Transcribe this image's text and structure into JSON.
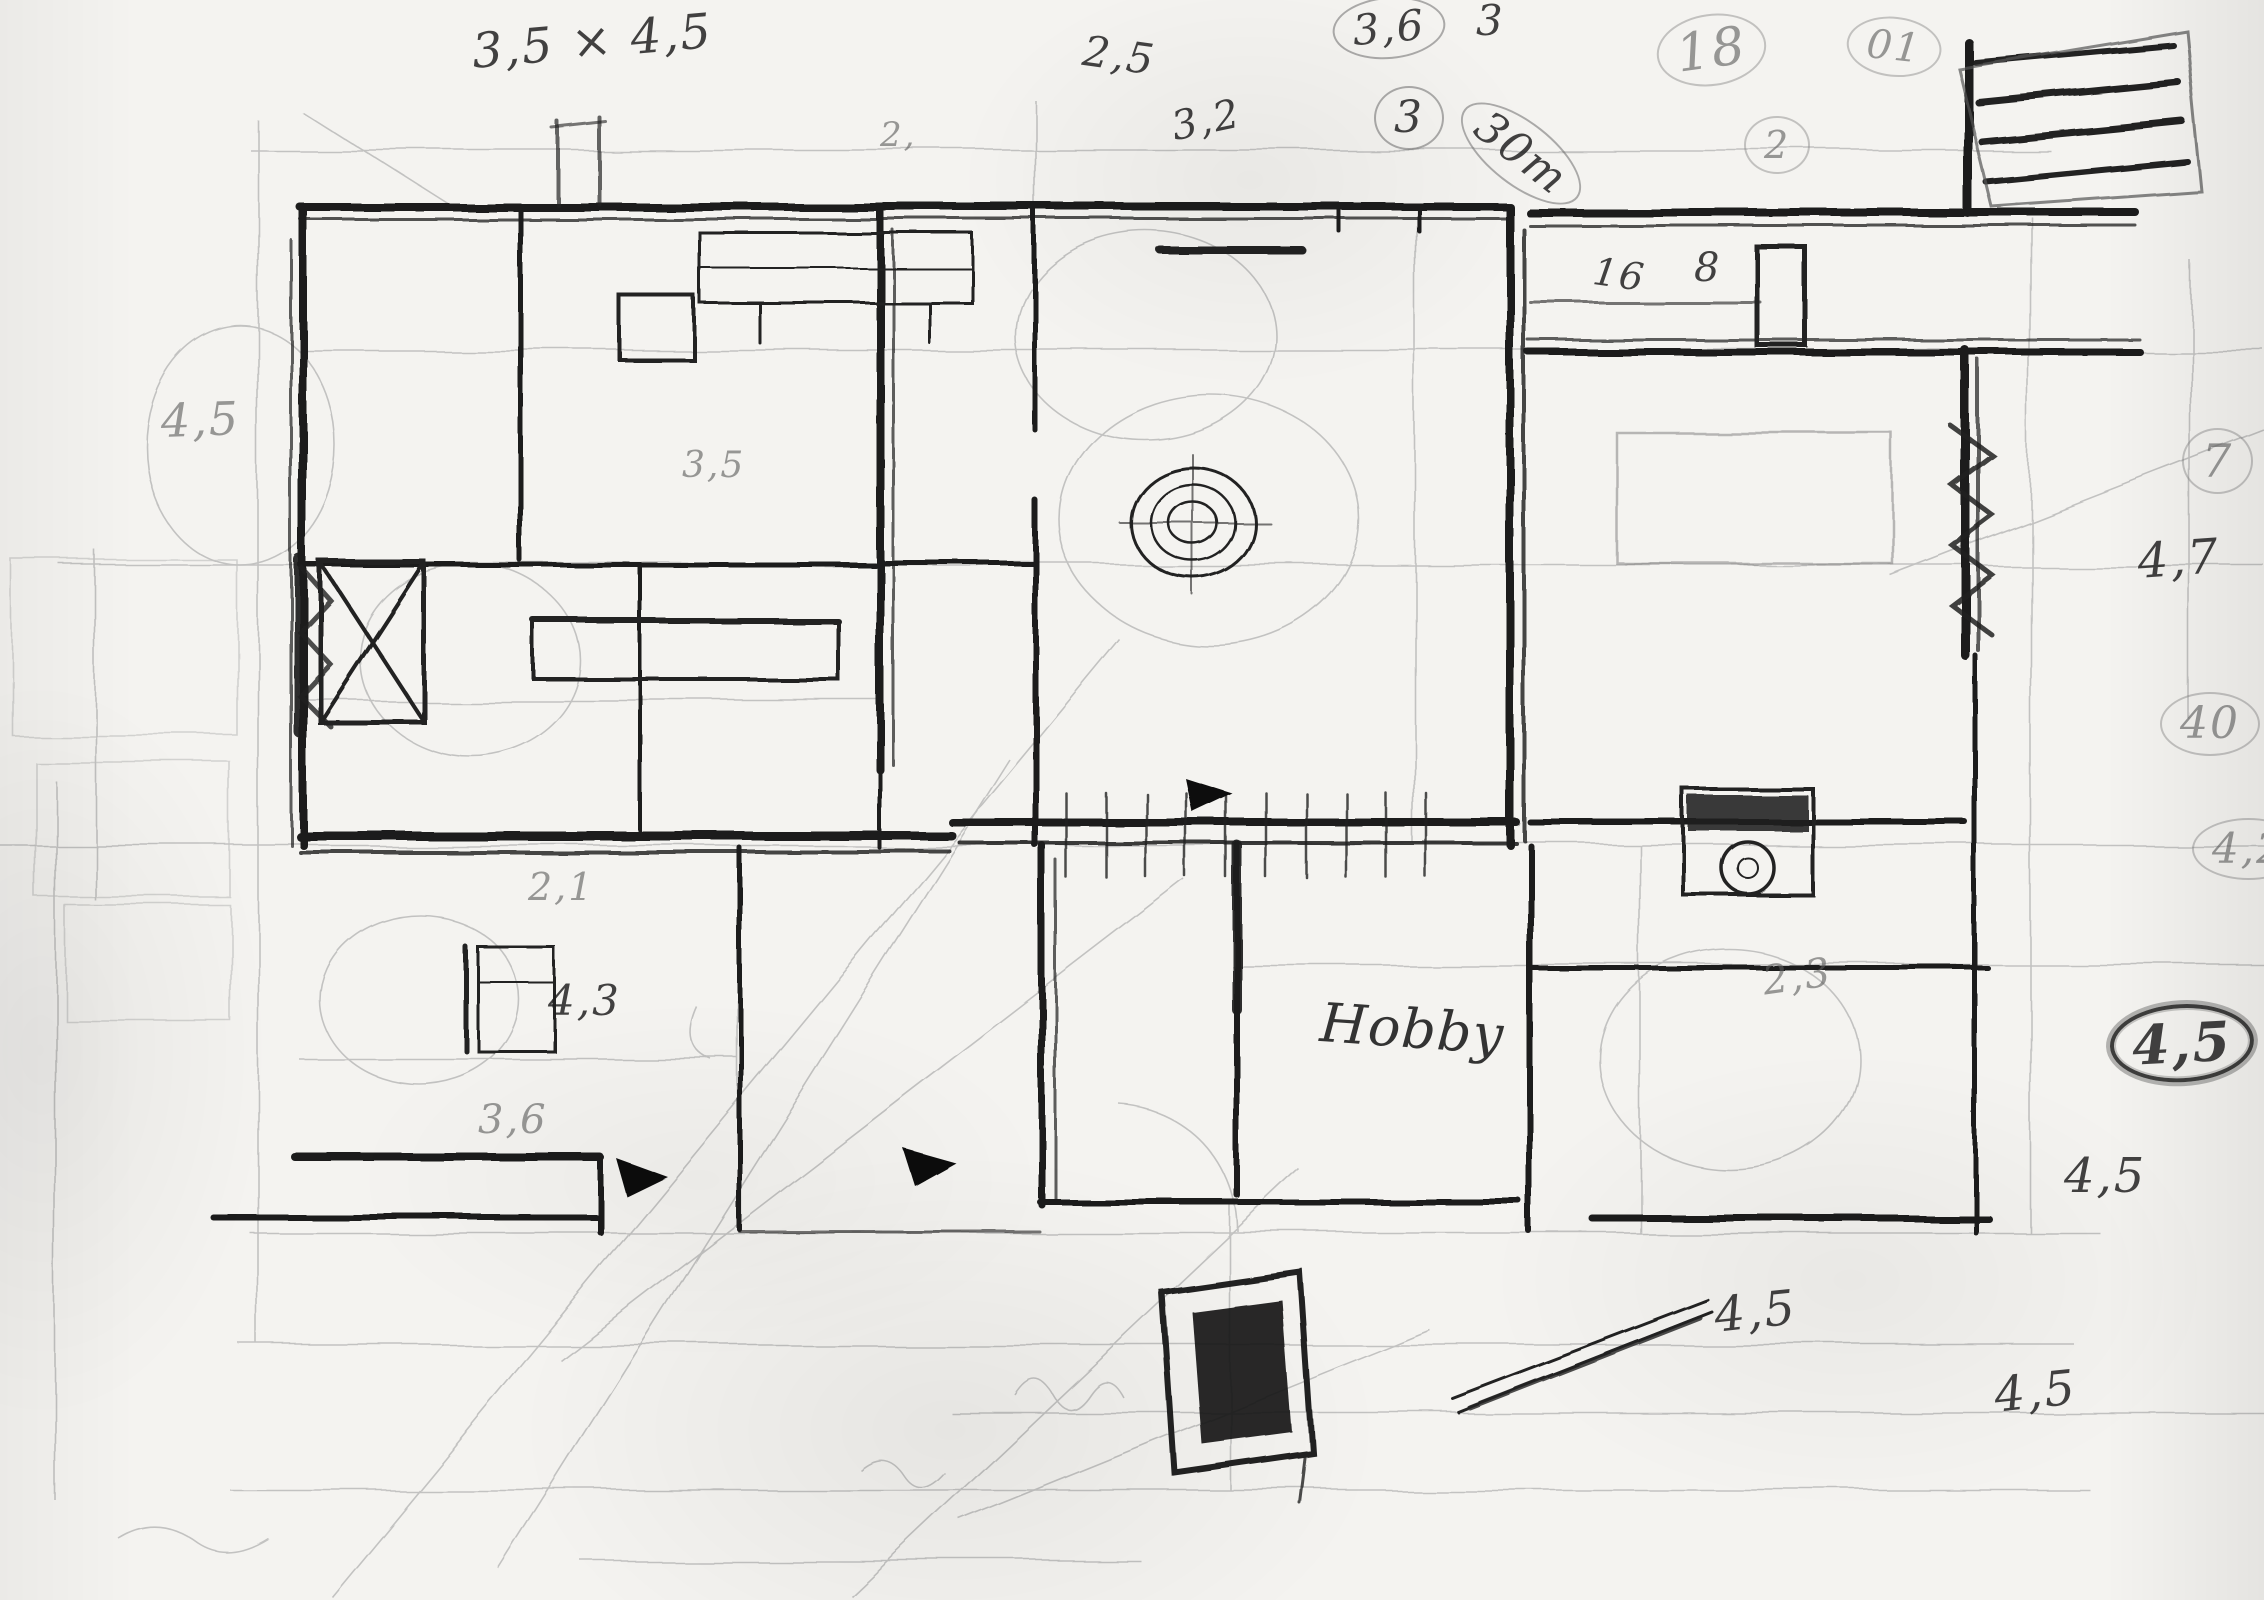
{
  "sketch": {
    "kind": "hand-drawn-floor-plan",
    "room_label": "Hobby"
  },
  "palette": {
    "paper": "#f4f3f0",
    "ink": "#1b1b1b",
    "pencil": "#8d8d8d"
  },
  "annotations": [
    {
      "id": "dim-top-left",
      "text": "3,5 × 4,5",
      "x": 470,
      "y": 28,
      "size": 48,
      "rotate": -5,
      "style": "ink"
    },
    {
      "id": "dim-2-5",
      "text": "2,5",
      "x": 1086,
      "y": 30,
      "size": 42,
      "rotate": 8,
      "style": "ink"
    },
    {
      "id": "dim-2-dot",
      "text": "2,",
      "x": 880,
      "y": 118,
      "size": 34,
      "rotate": 0,
      "style": "pencil"
    },
    {
      "id": "dim-3-2",
      "text": "3,2",
      "x": 1168,
      "y": 108,
      "size": 40,
      "rotate": -12,
      "style": "ink"
    },
    {
      "id": "dim-3-6-top",
      "text": "3,6",
      "x": 1330,
      "y": 2,
      "size": 42,
      "rotate": -5,
      "style": "ink",
      "circled": true
    },
    {
      "id": "dim-3-circled",
      "text": "3",
      "x": 1374,
      "y": 86,
      "size": 44,
      "rotate": 0,
      "style": "ink",
      "circled": true
    },
    {
      "id": "dim-3-top",
      "text": "3",
      "x": 1476,
      "y": 0,
      "size": 42,
      "rotate": 0,
      "style": "ink"
    },
    {
      "id": "dim-30m",
      "text": "30m",
      "x": 1484,
      "y": 84,
      "size": 44,
      "rotate": 38,
      "style": "ink",
      "circled": true
    },
    {
      "id": "dim-18",
      "text": "18",
      "x": 1652,
      "y": 22,
      "size": 52,
      "rotate": -8,
      "style": "pencil",
      "circled": true
    },
    {
      "id": "dim-01",
      "text": "01",
      "x": 1850,
      "y": 12,
      "size": 40,
      "rotate": 6,
      "style": "pencil",
      "circled": true
    },
    {
      "id": "dim-2-circled",
      "text": "2",
      "x": 1744,
      "y": 116,
      "size": 38,
      "rotate": 0,
      "style": "pencil",
      "circled": true
    },
    {
      "id": "dim-16",
      "text": "16",
      "x": 1596,
      "y": 252,
      "size": 38,
      "rotate": 8,
      "style": "ink"
    },
    {
      "id": "dim-8",
      "text": "8",
      "x": 1694,
      "y": 248,
      "size": 40,
      "rotate": 0,
      "style": "ink"
    },
    {
      "id": "dim-7",
      "text": "7",
      "x": 2182,
      "y": 428,
      "size": 46,
      "rotate": 0,
      "style": "pencil",
      "circled": true
    },
    {
      "id": "dim-4-7",
      "text": "4,7",
      "x": 2136,
      "y": 538,
      "size": 48,
      "rotate": -4,
      "style": "ink"
    },
    {
      "id": "dim-40",
      "text": "40",
      "x": 2160,
      "y": 692,
      "size": 44,
      "rotate": 0,
      "style": "pencil",
      "circled": true
    },
    {
      "id": "dim-4-2",
      "text": "4,2",
      "x": 2192,
      "y": 818,
      "size": 42,
      "rotate": 0,
      "style": "pencil",
      "circled": true
    },
    {
      "id": "dim-4-5-ringed",
      "text": "4,5",
      "x": 2108,
      "y": 1008,
      "size": 54,
      "rotate": -3,
      "style": "ink",
      "circled": true,
      "heavy": true
    },
    {
      "id": "dim-4-5-right",
      "text": "4,5",
      "x": 2064,
      "y": 1152,
      "size": 48,
      "rotate": 0,
      "style": "ink"
    },
    {
      "id": "dim-4-5-left",
      "text": "4,5",
      "x": 160,
      "y": 398,
      "size": 46,
      "rotate": -2,
      "style": "pencil"
    },
    {
      "id": "dim-3-5-mid",
      "text": "3,5",
      "x": 682,
      "y": 448,
      "size": 36,
      "rotate": 0,
      "style": "pencil"
    },
    {
      "id": "dim-2-1",
      "text": "2,1",
      "x": 528,
      "y": 868,
      "size": 38,
      "rotate": 0,
      "style": "pencil"
    },
    {
      "id": "dim-4-3",
      "text": "4,3",
      "x": 548,
      "y": 980,
      "size": 42,
      "rotate": 0,
      "style": "ink"
    },
    {
      "id": "dim-3-6-lower",
      "text": "3,6",
      "x": 478,
      "y": 1100,
      "size": 40,
      "rotate": 0,
      "style": "pencil"
    },
    {
      "id": "room-hobby",
      "text": "Hobby",
      "x": 1322,
      "y": 996,
      "size": 54,
      "rotate": 4,
      "style": "script"
    },
    {
      "id": "dim-2-3",
      "text": "2,3",
      "x": 1760,
      "y": 962,
      "size": 40,
      "rotate": -8,
      "style": "pencil"
    },
    {
      "id": "dim-4-5-bottom-mid",
      "text": "4,5",
      "x": 1712,
      "y": 1292,
      "size": 48,
      "rotate": -6,
      "style": "ink"
    },
    {
      "id": "dim-4-5-bottom-right",
      "text": "4,5",
      "x": 1992,
      "y": 1372,
      "size": 48,
      "rotate": -6,
      "style": "ink"
    }
  ]
}
